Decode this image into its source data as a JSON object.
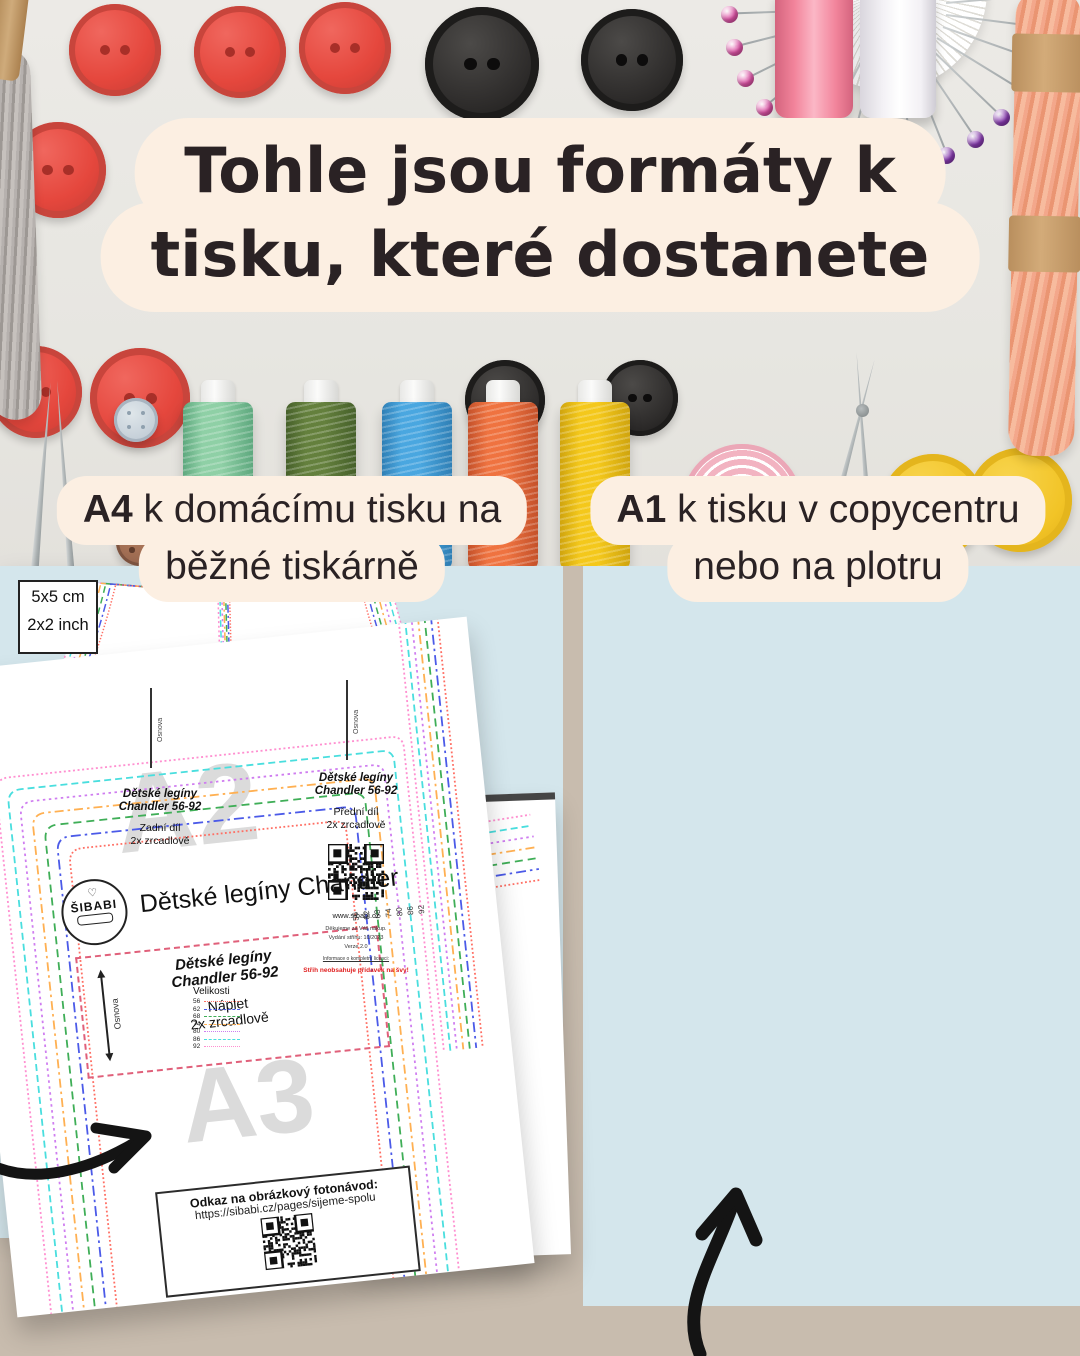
{
  "headline": {
    "line1": "Tohle jsou formáty k",
    "line2": "tisku, které dostanete"
  },
  "format_labels": {
    "a4": {
      "format": "A4",
      "text": " k domácímu tisku na",
      "line2": "běžné tiskárně"
    },
    "a1": {
      "format": "A1",
      "text": " k tisku v copycentru",
      "line2": "nebo na plotru"
    }
  },
  "left_document": {
    "watermark_top": "A2",
    "watermark_bottom": "A3",
    "logo": {
      "heart": "♡",
      "name": "ŠIBABI"
    },
    "title": "Dětské legíny Chandler",
    "piece_label": {
      "grainline": "Osnova",
      "name1": "Dětské legíny",
      "name2": "Chandler 56-92",
      "part": "Náplet",
      "cut": "2x zrcadlově"
    },
    "size_ticks": [
      "56",
      "62",
      "68",
      "74",
      "80",
      "86",
      "92"
    ],
    "qr_box": {
      "title": "Odkaz na obrázkový fotonávod:",
      "url": "https://sibabi.cz/pages/sijeme-spolu"
    }
  },
  "right_document": {
    "scale_box": {
      "metric": "5x5 cm",
      "imperial": "2x2 inch"
    },
    "grainline": "Osnova",
    "legend_title": "Velikosti",
    "back_piece": {
      "name1": "Dětské legíny",
      "name2": "Chandler 56-92",
      "part": "Zadní díl",
      "cut": "2x zrcadlově"
    },
    "front_piece": {
      "name1": "Dětské legíny",
      "name2": "Chandler 56-92",
      "part": "Přední díl",
      "cut": "2x zrcadlově",
      "website": "www.sibabi.cz",
      "thanks": "Děkujeme za Váš nákup.",
      "edition": "Vydání střihu: 10/2023",
      "version": "Verze 2.0",
      "license": "Informace o kompletní licenci:",
      "warning": "Střih neobsahuje přídavek na švy!"
    }
  },
  "sizes": [
    {
      "label": "92",
      "color": "#ff8fd0",
      "dash": "2 2.6",
      "legend_style": "dotted"
    },
    {
      "label": "86",
      "color": "#49dede",
      "dash": "7 4",
      "legend_style": "dashed"
    },
    {
      "label": "80",
      "color": "#cf7df0",
      "dash": "2.5 3.5",
      "legend_style": "dotted"
    },
    {
      "label": "74",
      "color": "#ffb052",
      "dash": "9 4 2.5 4",
      "legend_style": "dashed"
    },
    {
      "label": "68",
      "color": "#3fae57",
      "dash": "8 5",
      "legend_style": "dashed"
    },
    {
      "label": "62",
      "color": "#4b5ae8",
      "dash": "10 4 2.5 4",
      "legend_style": "dashed"
    },
    {
      "label": "56",
      "color": "#ff6e63",
      "dash": "1.8 2.4",
      "legend_style": "dotted"
    }
  ],
  "colors": {
    "cream": "#fcefe2",
    "panel_blue": "#d4e6ec",
    "backdrop_beige": "#c8bcae",
    "headline_text": "#2a2224",
    "red_button": "#e5473d",
    "black_button": "#2e2c2b",
    "yellow_button": "#f2c427",
    "pink_spool": "#f2849b",
    "white_spool": "#f3f1f5",
    "spool_mint": "#8fd0a6",
    "spool_olive": "#64803d",
    "spool_blue": "#4aa7e0",
    "spool_orange": "#ef7340",
    "spool_yellow": "#f4c81b",
    "tape_pink": "#f2b3c1",
    "floss_gray": "#b6b1ae",
    "floss_salmon": "#f3a78b",
    "pin_pink": "#e455ab",
    "pin_teal": "#2aa795",
    "pin_purple": "#8a3bb3",
    "arrow_black": "#141414"
  }
}
